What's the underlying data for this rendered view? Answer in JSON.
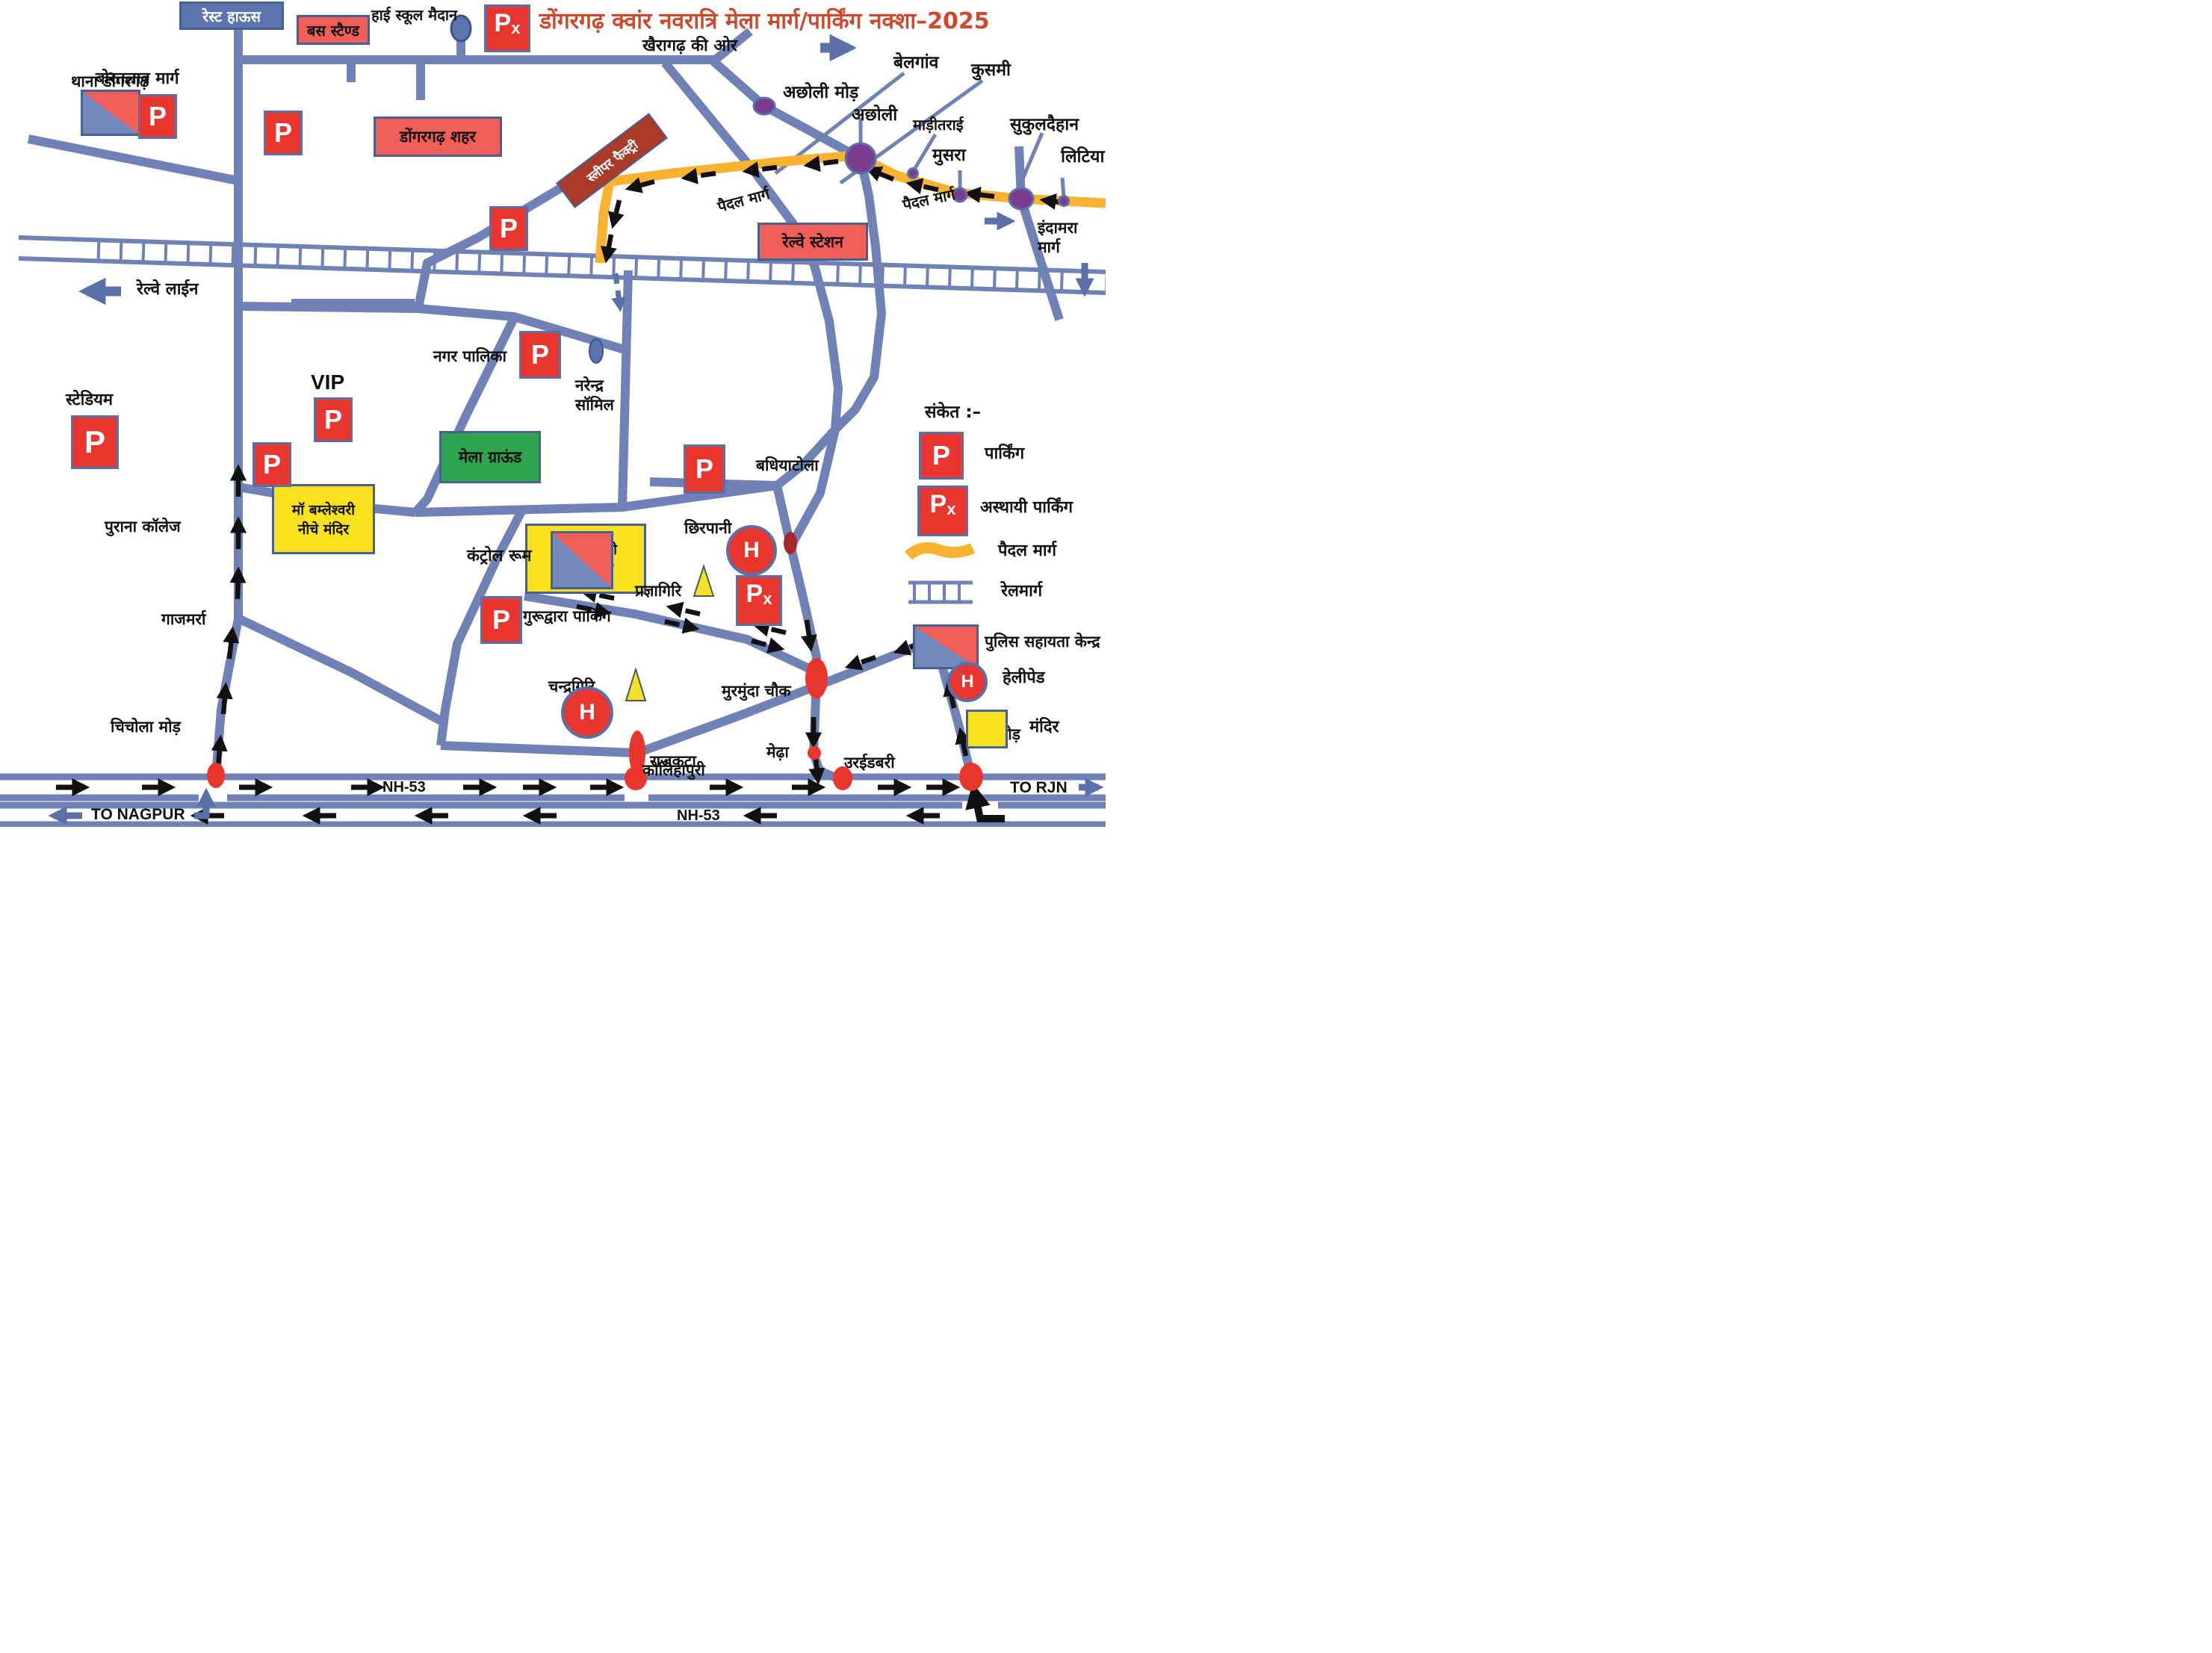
{
  "title": "डोंगरगढ़ क्वांर नवरात्रि मेला मार्ग/पार्किंग नक्शा–2025",
  "glyphs": {
    "p": "P",
    "px_p": "P",
    "px_x": "x",
    "h": "H",
    "vip": "VIP"
  },
  "legend": {
    "heading": "संकेत :–",
    "items": [
      {
        "name": "parking",
        "label": "पार्किंग"
      },
      {
        "name": "temporary-parking",
        "label": "अस्थायी पार्किंग"
      },
      {
        "name": "footpath",
        "label": "पैदल मार्ग"
      },
      {
        "name": "railway",
        "label": "रेलमार्ग"
      },
      {
        "name": "police-help-center",
        "label": "पुलिस सहायता केन्द्र"
      },
      {
        "name": "helipad",
        "label": "हेलीपेड"
      },
      {
        "name": "temple",
        "label": "मंदिर"
      }
    ]
  },
  "map": {
    "boxes": {
      "rest_house": "रेस्ट हाऊस",
      "bus_stand": "बस स्टैण्ड",
      "city": "डोंगरगढ़ शहर",
      "sleeper_factory": "स्लीपर फैक्ट्री",
      "railway_station": "रेल्वे स्टेशन",
      "mela_ground": "मेला ग्राऊंड",
      "temple_lower_l1": "मॉ बम्लेश्वरी",
      "temple_lower_l2": "नीचे मंदिर",
      "temple_upper_l1": "मॉ बम्लेश्वरी",
      "temple_upper_l2": "ऊपर मंदिर"
    },
    "labels": {
      "high_school": "हाई स्कूल मैदान",
      "belgaon": "बेलगांव",
      "kusmi": "कुसमी",
      "acholi_mod": "अछोली मोड़",
      "acholi": "अछोली",
      "maditarai": "माड़ीतराई",
      "sukuldehan": "सुकुलदैहान",
      "musra": "मुसरा",
      "litiya": "लिटिया",
      "indamara_l1": "इंदामरा",
      "indamara_l2": "मार्ग",
      "bortalav": "बोरतलाव मार्ग",
      "thana": "थाना डोगरगढ़",
      "nagar_palika": "नगर पालिका",
      "narendra_l1": "नरेन्द्र",
      "narendra_l2": "सॉमिल",
      "vip": "VIP",
      "stadium": "स्टेडियम",
      "purana_college": "पुराना कॉलेज",
      "control_room": "कंट्रोल रूम",
      "gurudwara": "गुरूद्वारा पार्किंग",
      "chhirpani": "छिरपानी",
      "badhiyatola": "बधियाटोला",
      "pragyagiri": "प्रज्ञागिरि",
      "chandragiri": "चन्द्रगिरि",
      "murmunda": "मुरमुंदा चौक",
      "rajkata": "राजकटा",
      "medha": "मेढ़ा",
      "gajmarra": "गाजमर्रा",
      "chichola": "चिचोला मोड़",
      "kolihapuri": "कोलिहापुरी",
      "uraidabri": "उरईडबरी",
      "tumdibod": "तुमड़ीबोड़",
      "sanket": "संकेत :–"
    },
    "road_labels": {
      "khairagarh": "खैरागढ़ की ओर",
      "railway_line": "रेल्वे लाईन",
      "footpath_left": "पैदल मार्ग",
      "footpath_right": "पैदल मार्ग",
      "nh53_top": "NH-53",
      "nh53_bottom": "NH-53",
      "to_nagpur": "TO NAGPUR",
      "to_rjn": "TO RJN"
    }
  },
  "colors": {
    "road": "#6f81b5",
    "path_yellow": "#f9b331",
    "marker_red": "#e8352e",
    "box_red": "#ef5f58",
    "box_yellow": "#f8e11d",
    "box_green": "#2ea44e",
    "purple_dot": "#7b3b8f",
    "title": "#d0482b"
  }
}
